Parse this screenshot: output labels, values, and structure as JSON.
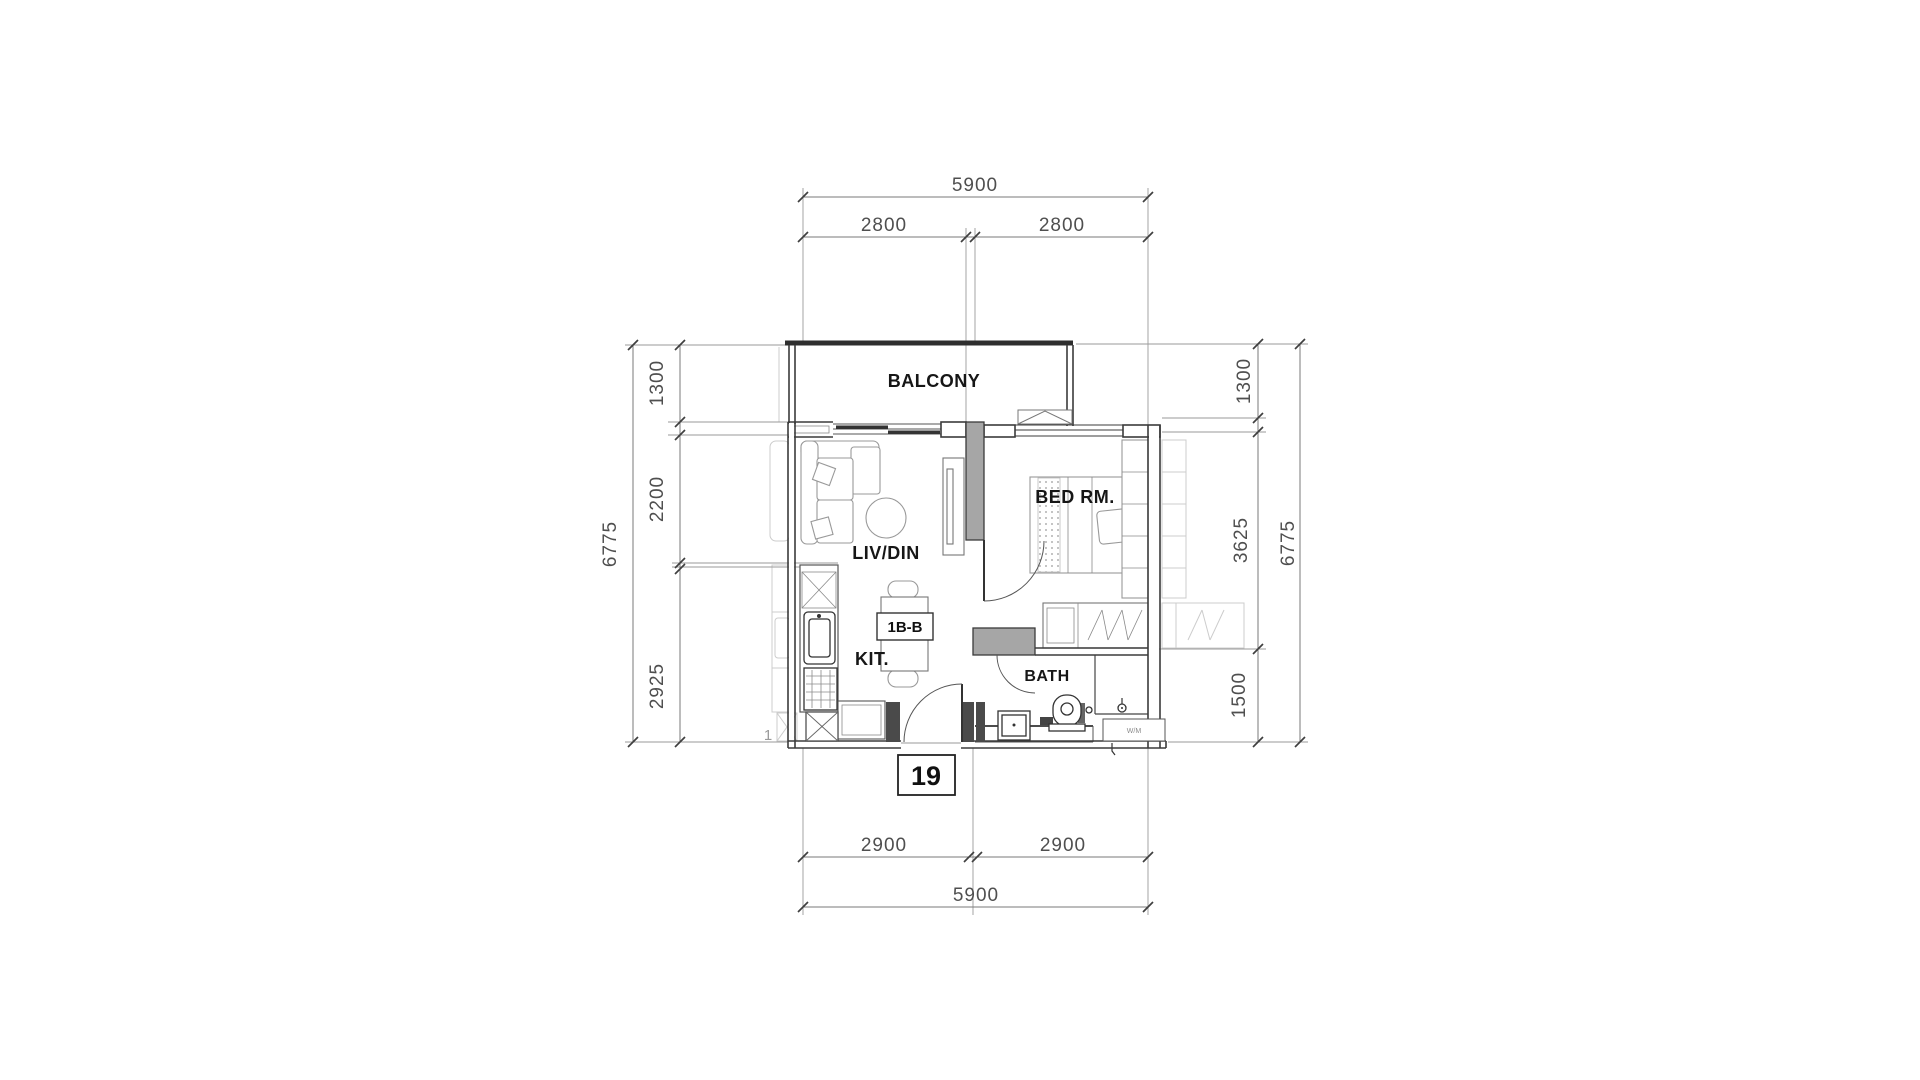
{
  "drawing": {
    "type": "apartment-unit-floor-plan",
    "unit": {
      "number": "19",
      "type_label": "1B-B"
    },
    "rooms": {
      "balcony": "BALCONY",
      "living_dining": "LIV/DIN",
      "bedroom": "BED RM.",
      "kitchen": "KIT.",
      "bath": "BATH"
    },
    "appliances": {
      "washer": "W/M"
    },
    "adjacent_unit": {
      "partial_label": "1"
    },
    "dimensions_mm": {
      "top": {
        "total": "5900",
        "left": "2800",
        "right": "2800"
      },
      "bottom": {
        "left": "2900",
        "right": "2900",
        "total": "5900"
      },
      "left": {
        "balcony": "1300",
        "living": "2200",
        "kitchen": "2925",
        "total": "6775"
      },
      "right": {
        "balcony": "1300",
        "bedroom": "3625",
        "bath": "1500",
        "total": "6775"
      }
    },
    "colors": {
      "wall_line": "#3b3b3b",
      "shear_wall_fill": "#a6a6a6",
      "dimension_text": "#4f4f4f",
      "background": "#ffffff"
    }
  }
}
